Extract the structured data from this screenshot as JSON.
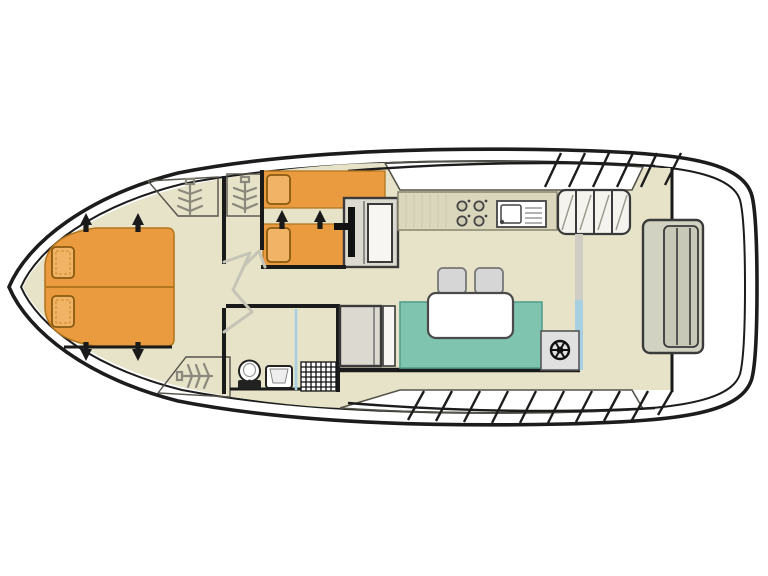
{
  "meta": {
    "title": "boat-deck-floor-plan",
    "canvas": {
      "width": 768,
      "height": 576
    }
  },
  "colors": {
    "background": "#ffffff",
    "hull_fill": "#ffffff",
    "floor": "#e6e3c8",
    "deck_white": "#fdfdfa",
    "bed": "#eb9b3f",
    "pillow": "#f1b466",
    "wardrobe": "#d7d5c9",
    "sofa": "#7fc4ae",
    "table": "#ffffff",
    "stool": "#d6d6d6",
    "counter": "#dbd7bd",
    "sink": "#ffffff",
    "steps": "#dcdad0",
    "steps_panel": "#f7f6f2",
    "steps_top": "#f4f3ee",
    "helm_box": "#e0e0e0",
    "bench": "#d2d2c2",
    "bench_inner": "#c8c8b8",
    "shower": "#ffffff",
    "glass_blue": "#a7cfe2",
    "track_gray": "#cfcdc3",
    "door_swing": "#c6c4b6",
    "burner": "#d0ccb4"
  },
  "areas": {
    "bow_cabin": {
      "label": "bow-double-cabin",
      "items": [
        "double-v-berth",
        "pillow-left",
        "pillow-right",
        "bed-direction-arrows"
      ]
    },
    "twin_cabin": {
      "label": "twin-bed-cabin",
      "items": [
        "single-bed-upper",
        "single-bed-lower",
        "pillows",
        "bed-direction-arrows",
        "vanity-steps-unit"
      ]
    },
    "corridor": {
      "label": "corridor",
      "items": [
        "door-swings",
        "wardrobe-hanging-lockers"
      ]
    },
    "bathroom": {
      "label": "bathroom",
      "items": [
        "toilet",
        "washbasin",
        "shower-tray",
        "shower-screen"
      ]
    },
    "saloon": {
      "label": "saloon-and-galley",
      "items": [
        "galley-counter",
        "stove-4-burner",
        "sink-with-drainer",
        "dinette-sofa",
        "dining-table",
        "stool",
        "stool",
        "helm-steering-wheel",
        "companionway-steps",
        "sliding-door-glass"
      ]
    },
    "aft_deck": {
      "label": "aft-deck",
      "items": [
        "stern-bench-seat",
        "boarding-steps-hatching"
      ]
    }
  },
  "icons": [
    "hanging-locker-icon",
    "steering-wheel-icon",
    "stove-burners-icon",
    "sink-drainer-icon",
    "toilet-icon",
    "washbasin-icon",
    "shower-grid-icon",
    "stairs-hatch-icon",
    "door-swing-icon",
    "direction-arrow-icon"
  ]
}
